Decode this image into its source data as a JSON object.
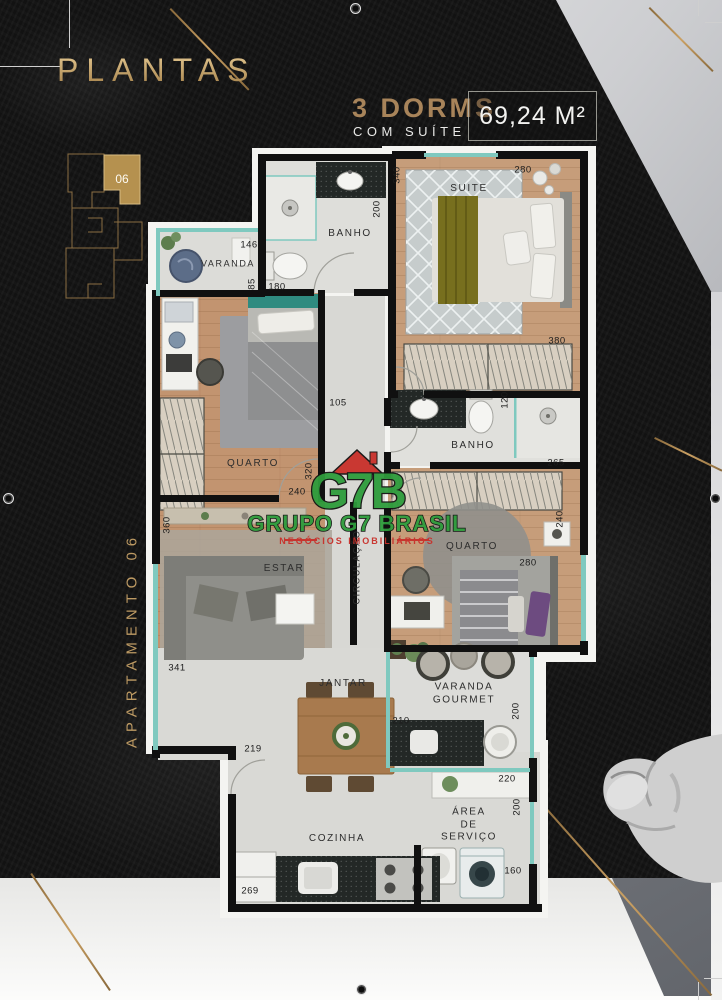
{
  "header": {
    "title": "PLANTAS",
    "dorms": "3 DORMS",
    "dorms_sub": "COM SUÍTE",
    "area": "69,24 M²"
  },
  "key_plan": {
    "unit": "06"
  },
  "side_label": "APARTAMENTO 06",
  "watermark": {
    "logo": "G7B",
    "name": "GRUPO G7 BRASIL",
    "tagline": "NEGÓCIOS IMOBILIÁRIOS"
  },
  "plan": {
    "rooms": [
      {
        "label": "SUITE",
        "x": 469,
        "y": 189
      },
      {
        "label": "BANHO",
        "x": 350,
        "y": 234
      },
      {
        "label": "VARANDA",
        "x": 228,
        "y": 264,
        "s": 9
      },
      {
        "label": "QUARTO",
        "x": 253,
        "y": 464
      },
      {
        "label": "BANHO",
        "x": 473,
        "y": 446
      },
      {
        "label": "QUARTO",
        "x": 472,
        "y": 547
      },
      {
        "label": "CIRCULAÇÃO",
        "x": 357,
        "y": 567,
        "r": -90,
        "s": 9
      },
      {
        "label": "ESTAR",
        "x": 284,
        "y": 569
      },
      {
        "label": "JANTAR",
        "x": 343,
        "y": 684
      },
      {
        "label": "VARANDA\nGOURMET",
        "x": 464,
        "y": 694
      },
      {
        "label": "ÁREA\nDE\nSERVIÇO",
        "x": 469,
        "y": 825
      },
      {
        "label": "COZINHA",
        "x": 337,
        "y": 839
      }
    ],
    "dims": [
      {
        "v": "146",
        "x": 249,
        "y": 245
      },
      {
        "v": "85",
        "x": 252,
        "y": 284,
        "r": -90
      },
      {
        "v": "180",
        "x": 277,
        "y": 287
      },
      {
        "v": "200",
        "x": 377,
        "y": 209,
        "r": -90
      },
      {
        "v": "340",
        "x": 397,
        "y": 175,
        "r": -90
      },
      {
        "v": "280",
        "x": 523,
        "y": 170
      },
      {
        "v": "380",
        "x": 557,
        "y": 341
      },
      {
        "v": "105",
        "x": 338,
        "y": 403
      },
      {
        "v": "320",
        "x": 309,
        "y": 471,
        "r": -90
      },
      {
        "v": "240",
        "x": 297,
        "y": 492
      },
      {
        "v": "120",
        "x": 505,
        "y": 400,
        "r": -90
      },
      {
        "v": "265",
        "x": 556,
        "y": 463
      },
      {
        "v": "240",
        "x": 560,
        "y": 519,
        "r": -90
      },
      {
        "v": "280",
        "x": 528,
        "y": 563
      },
      {
        "v": "360",
        "x": 167,
        "y": 525,
        "r": -90
      },
      {
        "v": "341",
        "x": 177,
        "y": 668
      },
      {
        "v": "219",
        "x": 253,
        "y": 749
      },
      {
        "v": "210",
        "x": 401,
        "y": 721
      },
      {
        "v": "200",
        "x": 516,
        "y": 711,
        "r": -90
      },
      {
        "v": "220",
        "x": 507,
        "y": 779
      },
      {
        "v": "200",
        "x": 517,
        "y": 807,
        "r": -90
      },
      {
        "v": "160",
        "x": 513,
        "y": 871
      },
      {
        "v": "269",
        "x": 250,
        "y": 891
      }
    ]
  }
}
